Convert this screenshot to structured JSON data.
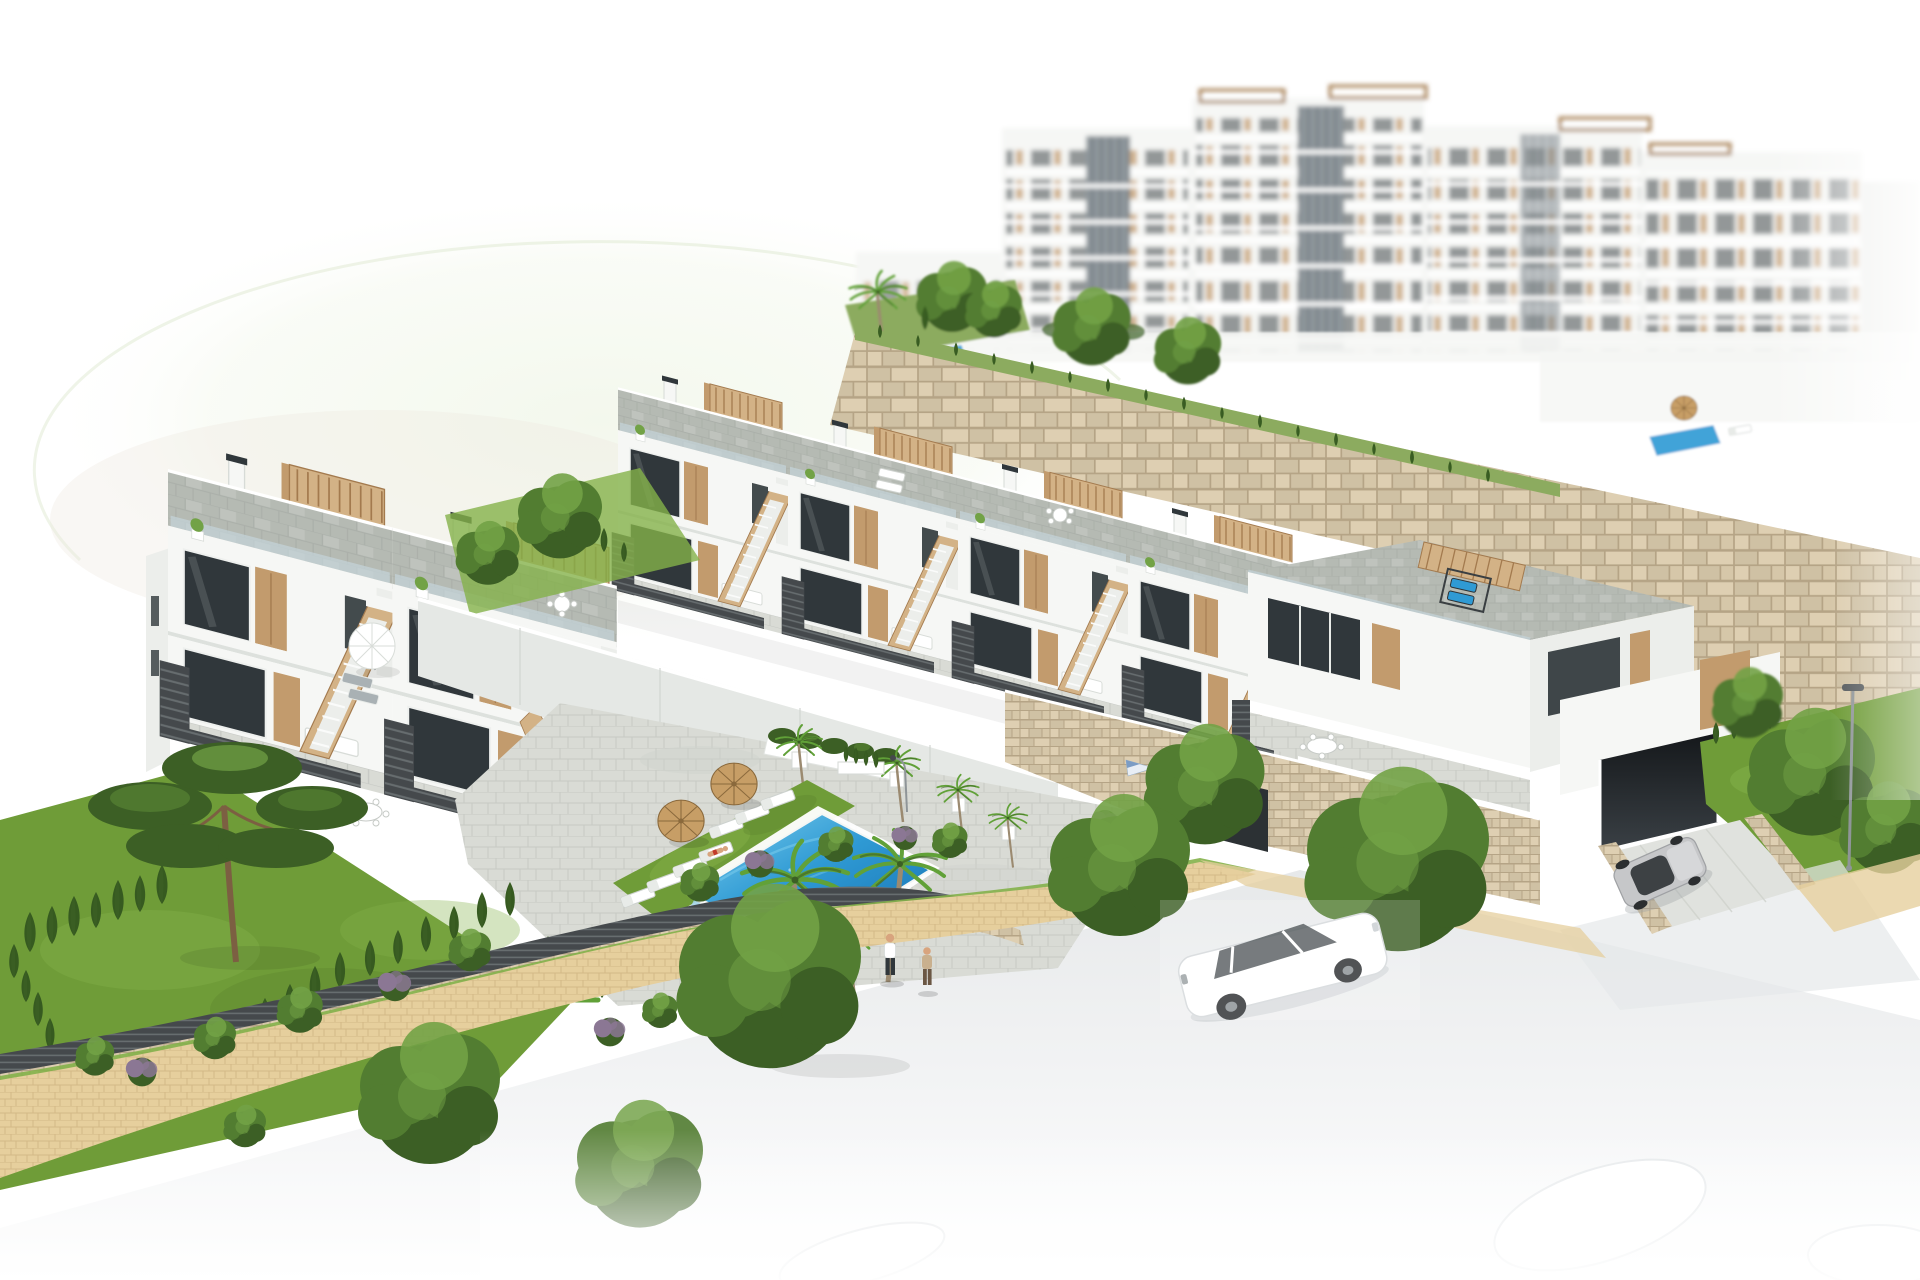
{
  "meta": {
    "title": "Aerial 3D architectural render - white Mediterranean residential complex",
    "description": "Computer-generated aerial rendering of a hillside development with rows of white two-storey townhouses with tan timber accents, paved roof terraces with pergolas, a communal pool garden with sun loungers and straw parasols, sand-coloured stone retaining walls, blurred taller apartment blocks behind, lawns with pine, palm and cypress trees, a cobbled footpath with two pedestrians, a white car on the street and a silver car at a garage ramp, all fading to white at the image edges."
  },
  "scene": {
    "background_buildings": {
      "label": "blurred multi-storey apartment blocks",
      "floors_visible": 5,
      "features": [
        "tan balcony panels",
        "grey glazing strips",
        "rooftop pergola frames",
        "roof terraces with small pools"
      ]
    },
    "retaining_walls": {
      "label": "sand-coloured rough stone retaining walls",
      "topping": "grass verge with young cypress trees"
    },
    "townhouses": {
      "rows": 3,
      "style": "white render, tan staircase parapets, dark louvre fences, glass balustrades, grey paved roof terraces with timber pergolas",
      "mid_row_units": 4,
      "left_block_units": 2,
      "corner_unit_with_garage": 1
    },
    "pool_area": {
      "pool": "rectangular blue pool with white coping, corner steps and ladder",
      "lawn_loungers": 7,
      "straw_parasols": 2,
      "sunbather_in_red": 1,
      "swimmer": 1,
      "potted_palms": 4,
      "planter_hedge": 1
    },
    "gardens": {
      "lawn": "large private lawn",
      "trees": [
        "stone pine",
        "tall palms",
        "fan palm",
        "leafy street trees"
      ],
      "hedges": "rows of cypress cones",
      "shrubs": "green and purple flowering bushes"
    },
    "street": {
      "footpath": "sand-coloured cobble path with grass verges and dark louvre fence",
      "pedestrians": 2,
      "white_car": 1,
      "silver_car_at_garage": 1,
      "street_lamp": 1,
      "flagpole": 1,
      "faded_cars_bottom": 3
    }
  },
  "palette": {
    "white": "#ffffff",
    "bld": "#f6f7f5",
    "bldShade": "#eceeeb",
    "bldDark": "#dde1dd",
    "win": "#30373b",
    "winGlass": "#6d7a80",
    "rail": "#c4d4da",
    "tan": "#c29b6d",
    "tanL": "#d3b286",
    "tanD": "#a37a4e",
    "roofPav": "#b5bab3",
    "roofPavL": "#c6cac3",
    "deck": "#d9dbd5",
    "deckJ": "#c5c8c2",
    "stone": "#cfc1a4",
    "stoneD": "#b5a486",
    "stoneL": "#decfb2",
    "grassTop": "#8cab5f",
    "lawn": "#6f9c38",
    "lawnL": "#84b14a",
    "lawnD": "#587f2a",
    "cyp": "#365a20",
    "treeM": "#527d31",
    "treeL": "#72a246",
    "treeD": "#3c5f25",
    "palm": "#61a138",
    "trunk": "#9b8a70",
    "pineTrunk": "#7c5f42",
    "poolL": "#7fd0ee",
    "poolM": "#2f9ad4",
    "poolD": "#156fb0",
    "path": "#e6cf9d",
    "pathJ": "#bfa272",
    "road": "#e7e9ea",
    "fence": "#45494c",
    "fenceL": "#6b7174",
    "straw": "#c79e66",
    "strawD": "#8a693c",
    "carSilver": "#c6c7c9",
    "skin": "#d8a47e",
    "red": "#c23a2a",
    "purple": "#8b7794",
    "flagBlue": "#7b9cc4",
    "lamp": "#8f9598",
    "orange": "#cf7a4e",
    "cloth": "#c9b08e",
    "brown": "#6b5744",
    "ramp": "#e5e8e5"
  }
}
